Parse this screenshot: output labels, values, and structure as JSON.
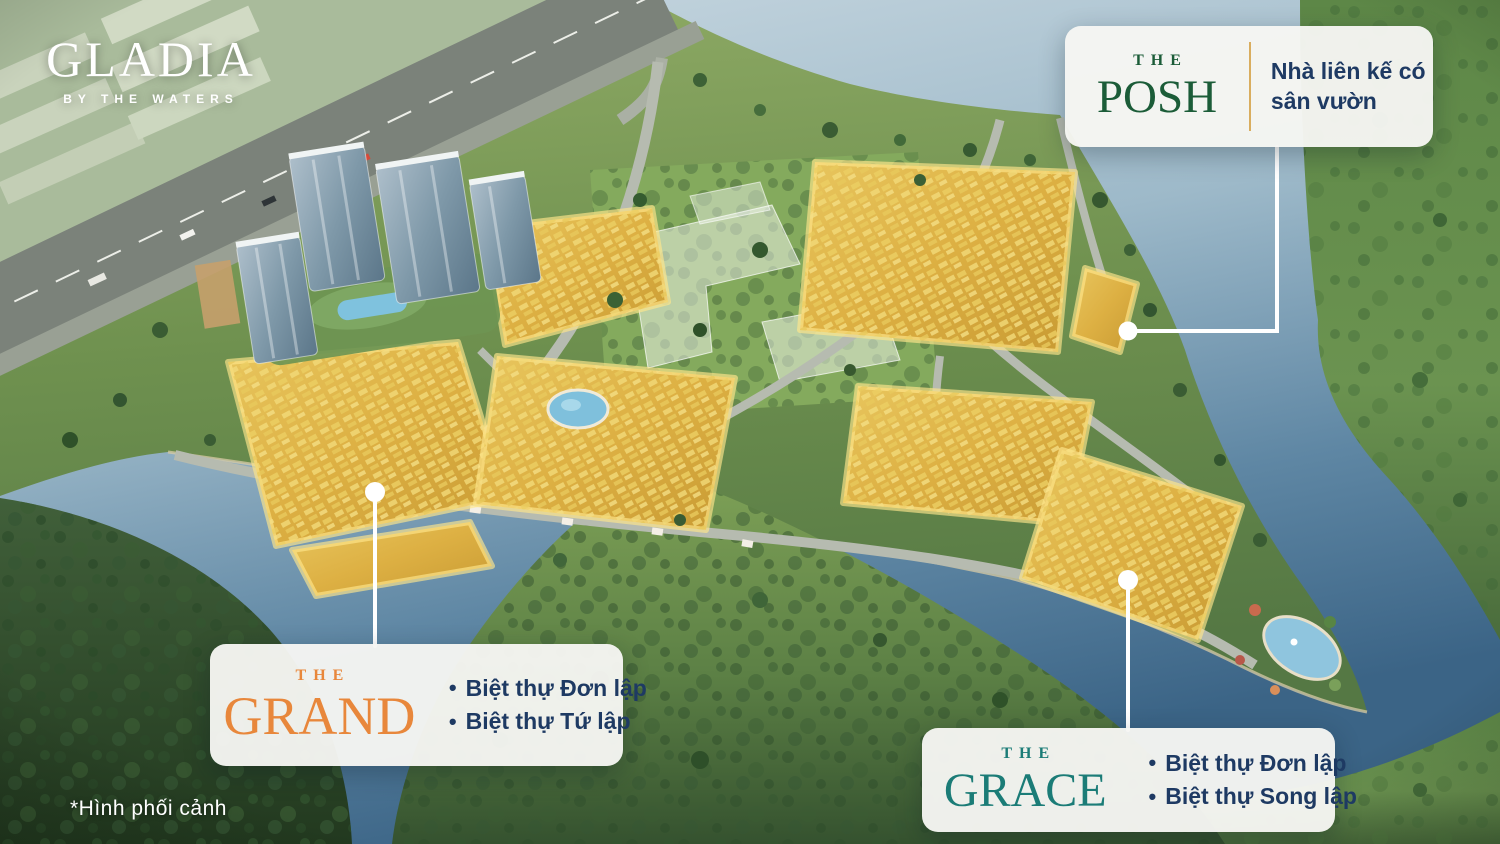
{
  "logo": {
    "title": "GLADIA",
    "subtitle": "BY THE WATERS"
  },
  "watermark": "*Hình phối cảnh",
  "ui": {
    "bullet_char": "•",
    "card_bg": "#f6f6f3",
    "divider_gold": "#d9ad5f",
    "text_navy": "#1e3a63",
    "connector_white": "#ffffff"
  },
  "callouts": {
    "posh": {
      "prefix": "THE",
      "name": "POSH",
      "name_color": "#1b5c38",
      "description": "Nhà liên kế có sân vườn"
    },
    "grand": {
      "prefix": "THE",
      "name": "GRAND",
      "name_color": "#e8873b",
      "bullets": [
        "Biệt thự Đơn lập",
        "Biệt thự Tứ lập"
      ]
    },
    "grace": {
      "prefix": "THE",
      "name": "GRACE",
      "name_color": "#1b7c77",
      "bullets": [
        "Biệt thự Đơn lập",
        "Biệt thự Song lập"
      ]
    }
  }
}
